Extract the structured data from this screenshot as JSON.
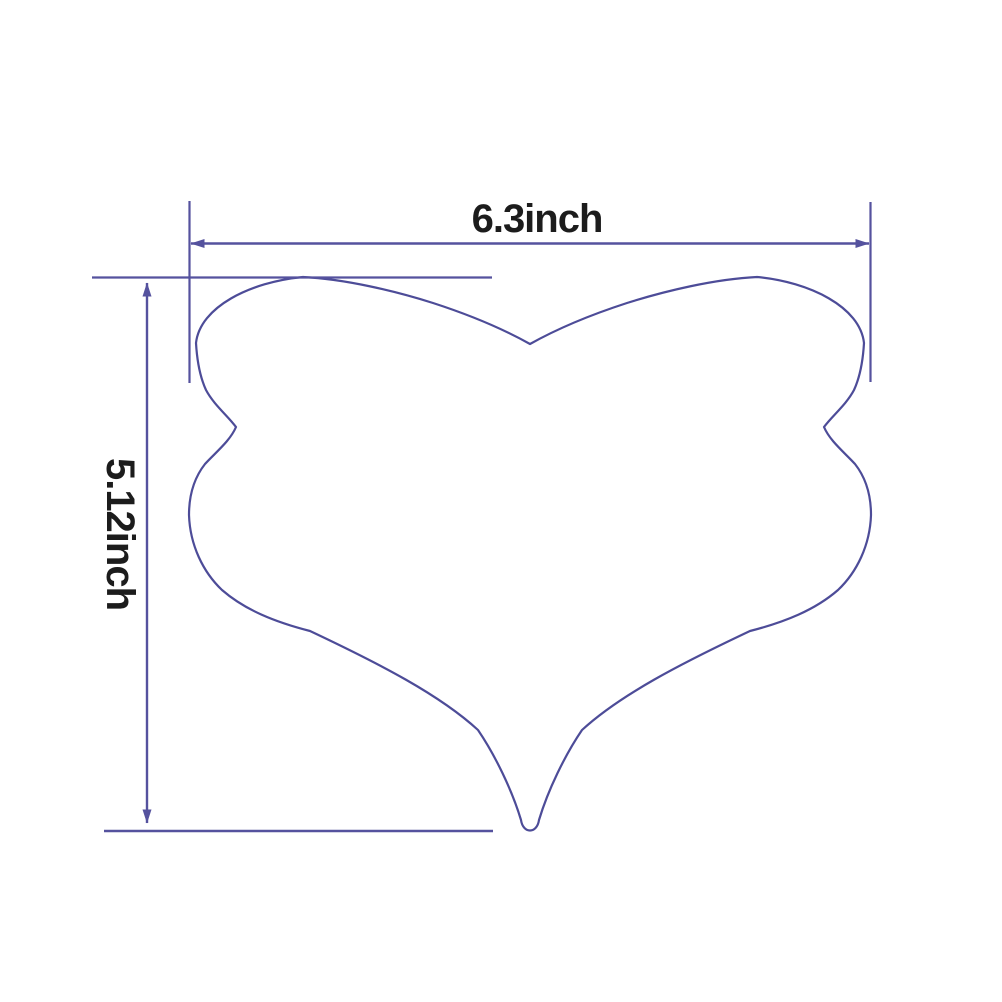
{
  "diagram": {
    "width_label": "6.3inch",
    "height_label": "5.12inch",
    "width_value_inches": 6.3,
    "height_value_inches": 5.12,
    "colors": {
      "line": "#4d4c98",
      "dimension": "#55529e",
      "text": "#1c1c1c",
      "background": "#ffffff"
    }
  }
}
